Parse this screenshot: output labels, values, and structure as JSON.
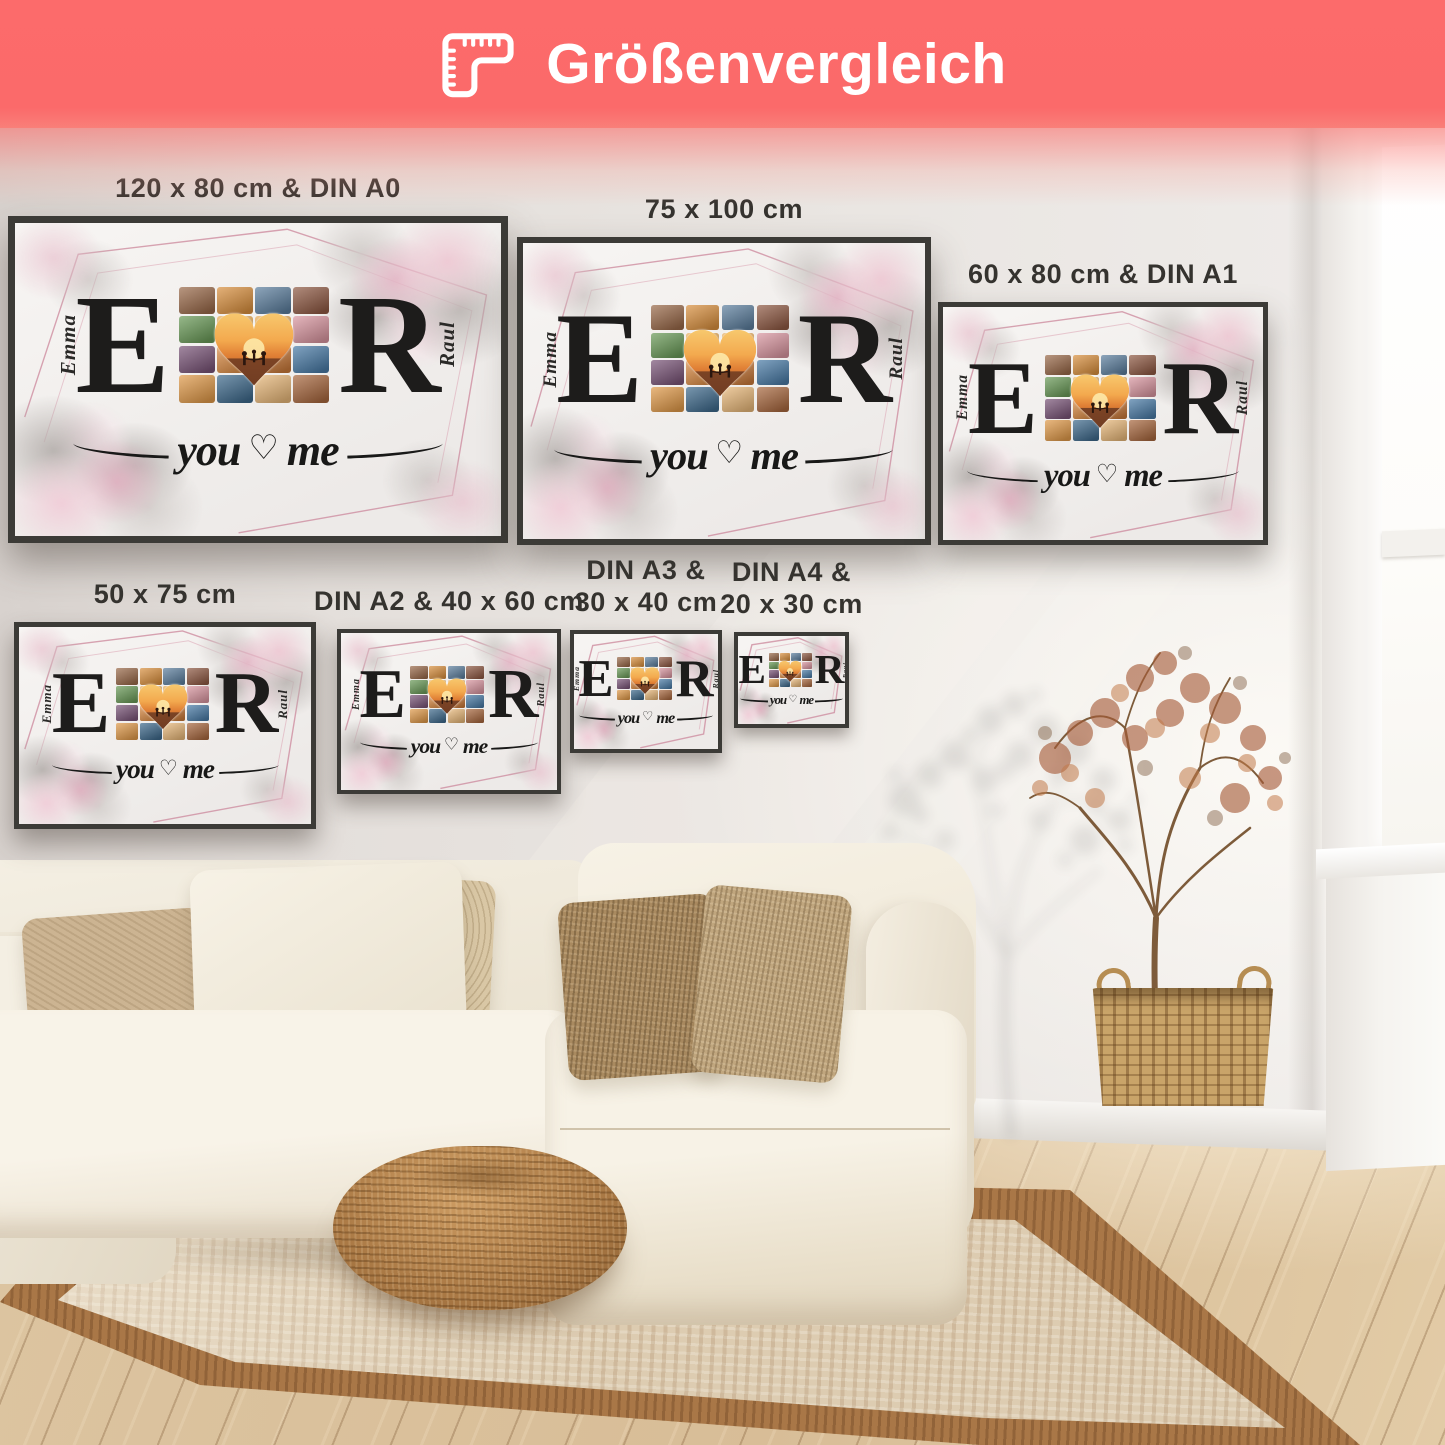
{
  "header": {
    "title": "Größenvergleich"
  },
  "posters": [
    {
      "id": "poster-120x80-din-a0",
      "label": "120 x 80 cm & DIN A0"
    },
    {
      "id": "poster-75x100",
      "label": "75 x 100 cm"
    },
    {
      "id": "poster-60x80-din-a1",
      "label": "60 x 80 cm & DIN A1"
    },
    {
      "id": "poster-50x75",
      "label": "50 x 75 cm"
    },
    {
      "id": "poster-din-a2-40x60",
      "label": "DIN A2 & 40 x 60 cm"
    },
    {
      "id": "poster-din-a3-30x40",
      "label": "DIN A3 &\n30 x 40 cm"
    },
    {
      "id": "poster-din-a4-20x30",
      "label": "DIN A4 &\n20 x 30 cm"
    }
  ],
  "poster_art": {
    "left_name": "Emma",
    "left_letter": "E",
    "right_name": "Raul",
    "right_letter": "R",
    "script_left": "you",
    "script_right": "me",
    "heart": "♡",
    "collage_colors": [
      "#9a6a4a",
      "#d9903f",
      "#5d7f9e",
      "#8f5a44",
      "#6a9a58",
      "#e8a94f",
      "#e8a94f",
      "#d996a0",
      "#7a5578",
      "#d98a43",
      "#c97a3b",
      "#4a7ba6",
      "#e09a4a",
      "#3f6a8c",
      "#e8b87a",
      "#a8683f"
    ]
  },
  "palette": {
    "banner": "#fc6b6b",
    "banner_text": "#ffffff",
    "wall": "#e6e2de",
    "label_text": "#35332f",
    "frame": "#3c3b37",
    "poster_background": "#f4f2f0",
    "rose_line": "#cf8ea1",
    "letter_ink": "#1d1c1b",
    "sofa_cream": "#f2ecdf",
    "pillow_brown": "#a98a60",
    "rug_field": "#ddccb1",
    "rug_border": "#a97747",
    "pouf": "#b9854e",
    "floor_wood": "#dcc4a0",
    "plant_foliage": "#a65b38",
    "basket": "#c9a469",
    "window_white": "#fbfaf8"
  }
}
